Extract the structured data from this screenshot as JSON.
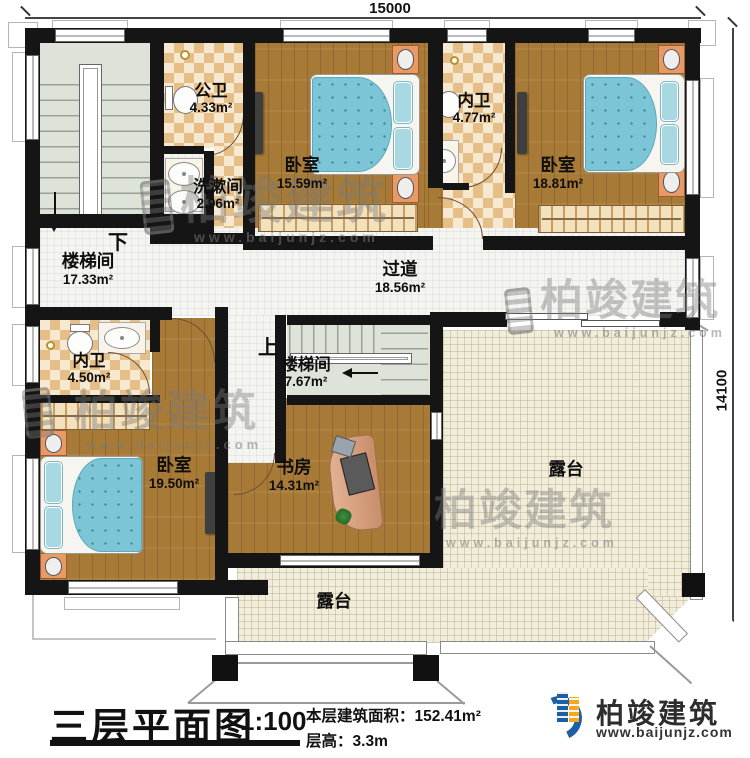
{
  "dimensions": {
    "top": "15000",
    "right": "14100"
  },
  "rooms": {
    "stairhall_left": {
      "name": "楼梯间",
      "area": "17.33m²"
    },
    "public_bath": {
      "name": "公卫",
      "area": "4.33m²"
    },
    "washroom": {
      "name": "洗漱间",
      "area": "2.96m²"
    },
    "bedroom_top": {
      "name": "卧室",
      "area": "15.59m²"
    },
    "ensuite_top": {
      "name": "内卫",
      "area": "4.77m²"
    },
    "bedroom_right": {
      "name": "卧室",
      "area": "18.81m²"
    },
    "hallway": {
      "name": "过道",
      "area": "18.56m²"
    },
    "ensuite_left": {
      "name": "内卫",
      "area": "4.50m²"
    },
    "stairhall_mid": {
      "name": "楼梯间",
      "area": "7.67m²"
    },
    "bedroom_bottom": {
      "name": "卧室",
      "area": "19.50m²"
    },
    "study": {
      "name": "书房",
      "area": "14.31m²"
    },
    "terrace_right": {
      "name": "露台"
    },
    "terrace_bottom": {
      "name": "露台"
    }
  },
  "stairs": {
    "down": "下",
    "up": "上"
  },
  "title_block": {
    "title": "三层平面图",
    "scale": "1:100",
    "floor_area_label": "本层建筑面积：",
    "floor_area_value": "152.41m²",
    "floor_height_label": "层高：",
    "floor_height_value": "3.3m"
  },
  "brand": {
    "name": "柏竣建筑",
    "website": "www.baijunjz.com",
    "logo_icon": "blue-swoosh-buildings"
  },
  "watermark": {
    "text": "柏竣建筑",
    "website": "www.baijunjz.com"
  }
}
